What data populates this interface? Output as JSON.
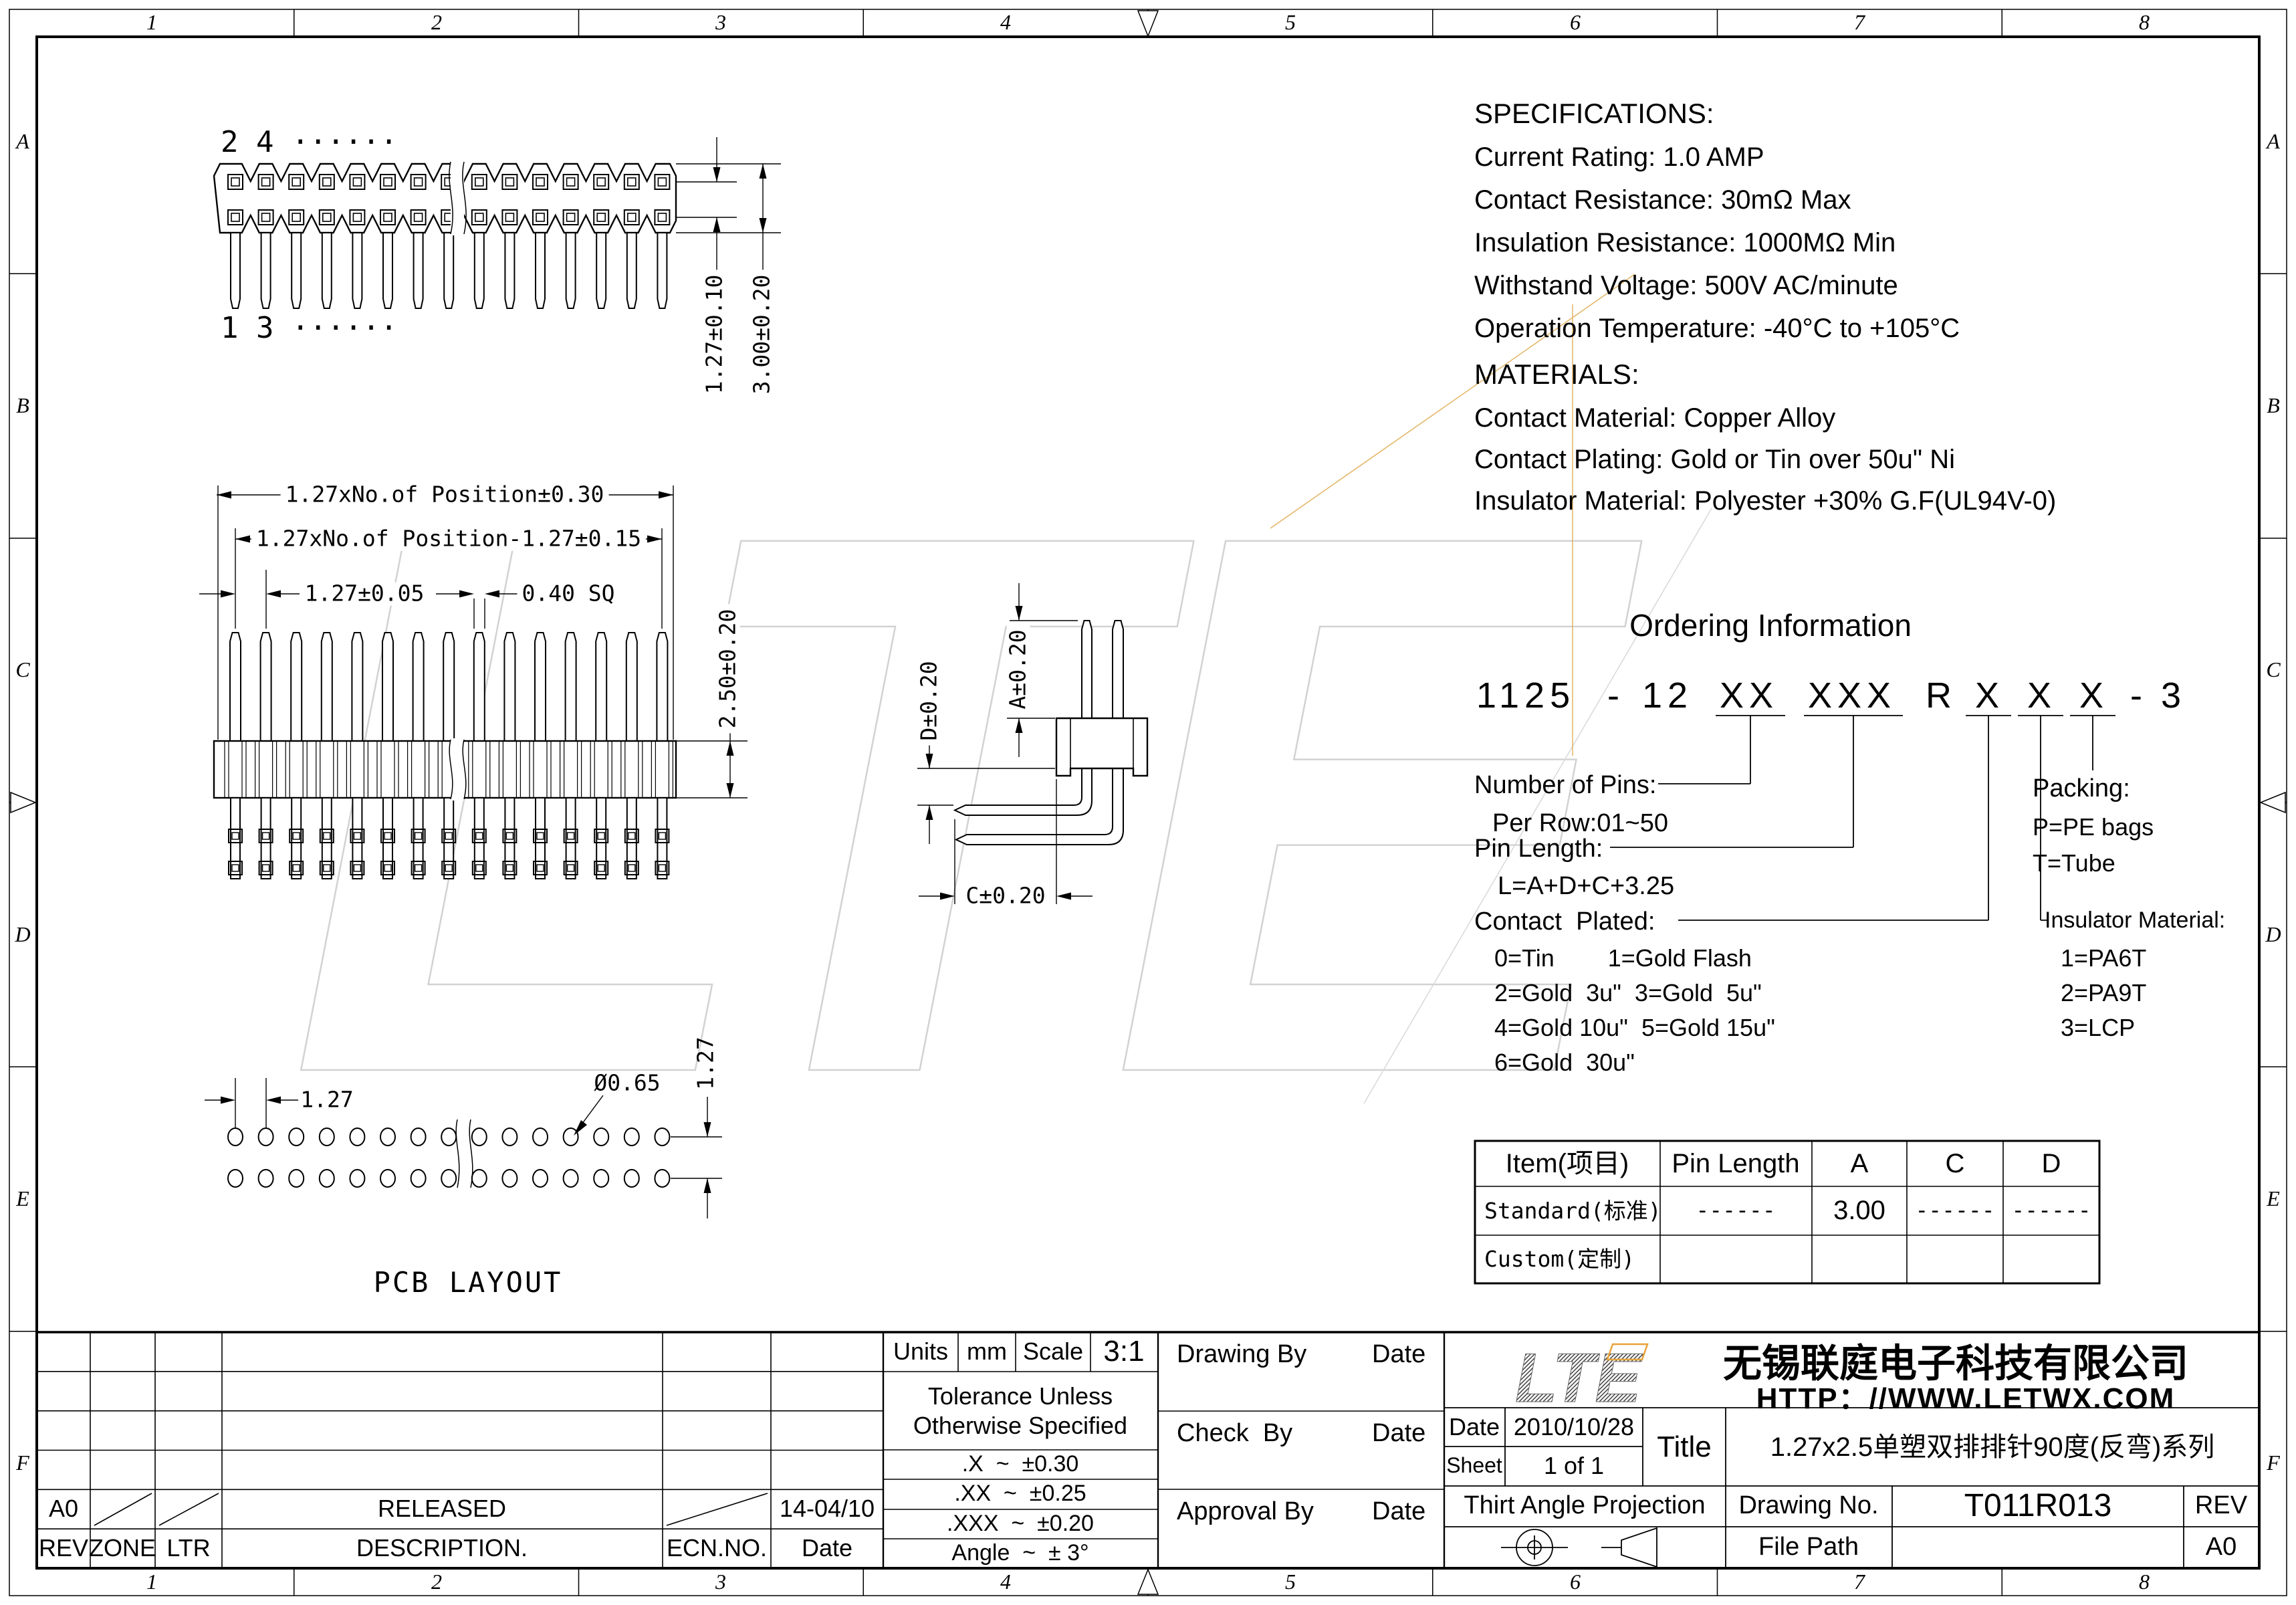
{
  "frame": {
    "cols": [
      "1",
      "2",
      "3",
      "4",
      "5",
      "6",
      "7",
      "8"
    ],
    "rows": [
      "A",
      "B",
      "C",
      "D",
      "E",
      "F"
    ]
  },
  "specs": {
    "title": "SPECIFICATIONS:",
    "lines": [
      "Current Rating: 1.0 AMP",
      "Contact Resistance: 30mΩ Max",
      "Insulation Resistance: 1000MΩ Min",
      "Withstand Voltage: 500V AC/minute",
      "Operation Temperature: -40°C to +105°C"
    ]
  },
  "materials": {
    "title": "MATERIALS:",
    "lines": [
      "Contact Material: Copper Alloy",
      "Contact Plating: Gold or Tin over 50u\" Ni",
      "Insulator Material: Polyester +30% G.F(UL94V-0)"
    ]
  },
  "ordering": {
    "title": "Ordering Information",
    "part": [
      "1125",
      "-",
      "12",
      "XX",
      "XXX",
      "R",
      "X",
      "X",
      "X",
      "-",
      "3"
    ],
    "pins": {
      "label": "Number of Pins:",
      "detail": "Per Row:01~50"
    },
    "pin_length": {
      "label": "Pin Length:",
      "detail": "L=A+D+C+3.25"
    },
    "plating": {
      "label": "Contact  Plated:",
      "rows": [
        "0=Tin        1=Gold Flash",
        "2=Gold  3u\"  3=Gold  5u\"",
        "4=Gold 10u\"  5=Gold 15u\"",
        "6=Gold  30u\""
      ]
    },
    "packing": {
      "label": "Packing:",
      "rows": [
        "P=PE bags",
        "T=Tube"
      ]
    },
    "insulator": {
      "label": "Insulator Material:",
      "rows": [
        "1=PA6T",
        "2=PA9T",
        "3=LCP"
      ]
    }
  },
  "dims": {
    "top_pitch": "1.27±0.10",
    "top_height": "3.00±0.20",
    "front_total": "1.27xNo.of Position±0.30",
    "front_inner": "1.27xNo.of Position-1.27±0.15",
    "front_pitch": "1.27±0.05",
    "front_pin": "0.40 SQ",
    "front_body": "2.50±0.20",
    "side_a": "A±0.20",
    "side_d": "D±0.20",
    "side_c": "C±0.20",
    "pcb_pitch_h": "1.27",
    "pcb_hole": "Ø0.65",
    "pcb_pitch_v": "1.27"
  },
  "labels": {
    "row24": "2 4 ······",
    "row13": "1 3 ······",
    "pcb": "PCB LAYOUT"
  },
  "table": {
    "headers": [
      "Item(项目)",
      "Pin Length",
      "A",
      "C",
      "D"
    ],
    "rows": [
      [
        "Standard(标准)",
        "------",
        "3.00",
        "------",
        "------"
      ],
      [
        "Custom(定制)",
        "",
        "",
        "",
        ""
      ]
    ]
  },
  "tb": {
    "units_label": "Units",
    "units": "mm",
    "scale_label": "Scale",
    "scale": "3:1",
    "tol1": "Tolerance Unless",
    "tol2": "Otherwise Specified",
    "tol_x": ".X  ~  ±0.30",
    "tol_xx": ".XX  ~  ±0.25",
    "tol_xxx": ".XXX  ~  ±0.20",
    "tol_angle": "Angle  ~  ± 3°",
    "drawing_by": "Drawing By",
    "check_by": "Check  By",
    "approval_by": "Approval By",
    "date_col": "Date",
    "rev_val": "A0",
    "released": "RELEASED",
    "released_date": "14-04/10",
    "rev": "REV",
    "zone": "ZONE",
    "ltr": "LTR",
    "desc": "DESCRIPTION.",
    "ecn": "ECN.NO.",
    "date_hdr": "Date",
    "logo": "LTE",
    "company": "无锡联庭电子科技有限公司",
    "url": "HTTP：//WWW.LETWX.COM",
    "date_label": "Date",
    "date_val": "2010/10/28",
    "sheet_label": "Sheet",
    "sheet_val": "1 of 1",
    "title_label": "Title",
    "title_val": "1.27x2.5单塑双排排针90度(反弯)系列",
    "projection": "Thirt Angle Projection",
    "drawing_no_label": "Drawing No.",
    "drawing_no": "T011R013",
    "rev_label": "REV",
    "file_path": "File Path",
    "size": "A0"
  }
}
